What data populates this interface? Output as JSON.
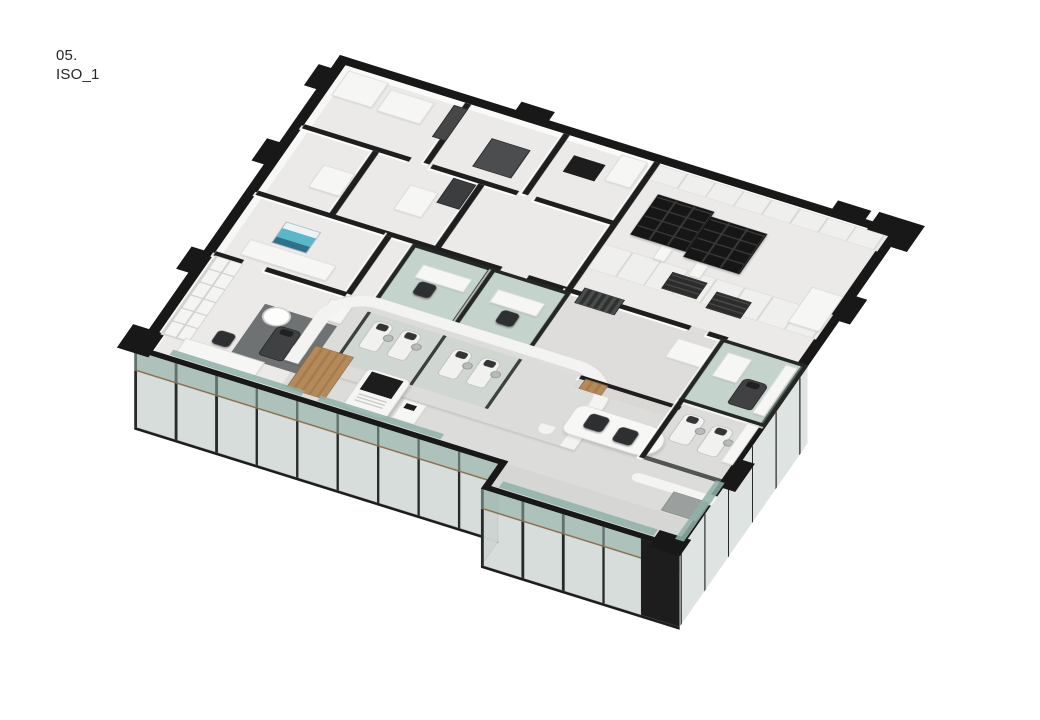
{
  "page": {
    "background": "#ffffff",
    "label_line1": "05.",
    "label_line2": "ISO_1"
  },
  "scene": {
    "kind": "isometric cutaway floor-plan render of a dental clinic",
    "view": "axonometric from south-west above, floor slab cut, black wall caps"
  },
  "palette": {
    "wall_cap_black": "#1e1e1e",
    "interior_wall_white": "#f6f6f4",
    "floor_light": "#eceae8",
    "floor_public_gray": "#dcdcda",
    "glass_partition_teal": "#9ebbb2",
    "facade_glass": "#96a5a0",
    "facade_frame": "#272a29",
    "wood_door_tan": "#b08956",
    "equipment_dark": "#1d1d1d",
    "sterilizer_blue": "#58b8c8",
    "reception_sign": "· · · · ·"
  }
}
